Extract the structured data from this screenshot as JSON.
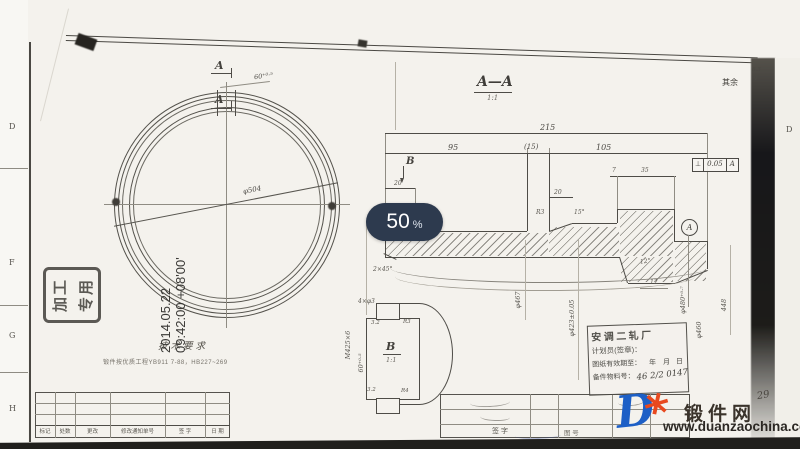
{
  "viewer": {
    "zoom_badge": {
      "value": "50",
      "unit": "%"
    }
  },
  "margin": {
    "left_letters": [
      "D",
      "F",
      "G",
      "H"
    ],
    "right_letter": "D",
    "page_number": "29",
    "surface_note": {
      "prefix": "其余",
      "roughness": "6.3"
    }
  },
  "ring_view": {
    "section_arrow_top": "A",
    "section_arrow_bottom": "A",
    "slot_width_dim": "60⁺⁰·⁵",
    "diameter_dim": "φ504"
  },
  "section_view": {
    "title": "A—A",
    "scale": "1:1",
    "dims": {
      "total_length": "215",
      "left_length": "95",
      "slot_length": "(15)",
      "right_length": "105",
      "step_7": "7",
      "step_35": "35",
      "left_20": "20",
      "ramp_20": "20",
      "taper_12": "12",
      "angle_15": "15°",
      "angle_12": "12°",
      "fillet_r3": "R3",
      "chamfer": "2×45°",
      "detail_arrow": "B"
    },
    "tolerance_frame": {
      "symbol": "⊥",
      "value": "0.05",
      "datum": "A"
    },
    "datum_label": "A",
    "vertical_dims": [
      "φ467",
      "φ423±0.05",
      "φ480⁺⁰·⁷",
      "φ460",
      "448"
    ]
  },
  "detail_view": {
    "label": "B",
    "scale": "1:1",
    "thread_dim": "M425×6",
    "width_dim": "60⁺⁰·⁵",
    "holes_dim": "4×φ3",
    "roughness_top": "3.2",
    "roughness_bottom": "3.2",
    "radius_top": "R3",
    "radius_bottom": "R4"
  },
  "tech_requirements": {
    "title": "技术要求",
    "line1": "锻件按优质工程YB911 7-88，HB227~269"
  },
  "machining_stamp": {
    "row1": "加工",
    "row2": "专用"
  },
  "signature_timestamp": {
    "date": "2014.05.22",
    "time": "09:42:00 +08'00'"
  },
  "plan_stamp": {
    "factory": "安调二轧厂",
    "planner_label": "计划员(签章)：",
    "validity_label": "图纸有效期至：",
    "year_label": "年",
    "month_label": "月",
    "day_label": "日",
    "material_label": "备件物料号：",
    "material_value": "46 2/2 0147"
  },
  "revision_table": {
    "labels": [
      "标记",
      "处数",
      "更改",
      "修改通知单号",
      "签 字",
      "日 期"
    ]
  },
  "title_block": {
    "sign_label": "签 字",
    "drawing_no_label": "图 号"
  },
  "watermark": {
    "logo_letter": "D",
    "gear_glyph": "*",
    "site_name": "锻件网",
    "site_url": "www.duanzaochina.com"
  }
}
